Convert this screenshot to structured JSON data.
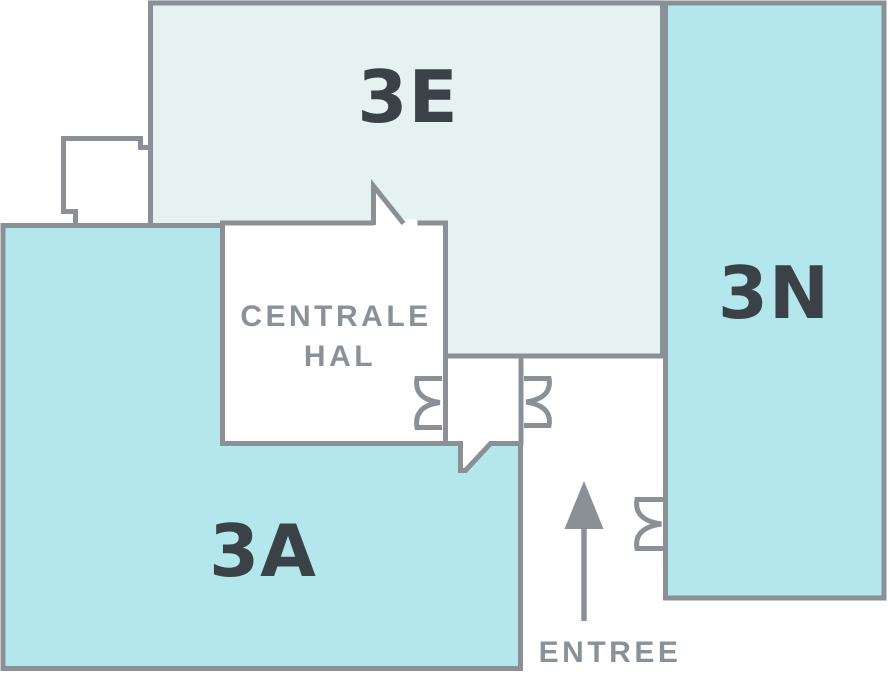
{
  "colors": {
    "wall_gray": "#8a9096",
    "room_light_fill": "#e6f1f1",
    "room_teal_fill": "#b3e7eb",
    "dark_label": "#3b4247",
    "gray_label": "#8a9198",
    "background": "#ffffff"
  },
  "floorplan": {
    "rooms": [
      {
        "id": "3E",
        "label": "3E"
      },
      {
        "id": "3N",
        "label": "3N"
      },
      {
        "id": "3A",
        "label": "3A"
      },
      {
        "id": "centrale-hal",
        "label_line1": "CENTRALE",
        "label_line2": "HAL"
      }
    ],
    "entrance": {
      "label": "ENTREE"
    },
    "icons": [
      "entrance-arrow-icon",
      "double-door-icon",
      "door-leaf-icon"
    ]
  }
}
